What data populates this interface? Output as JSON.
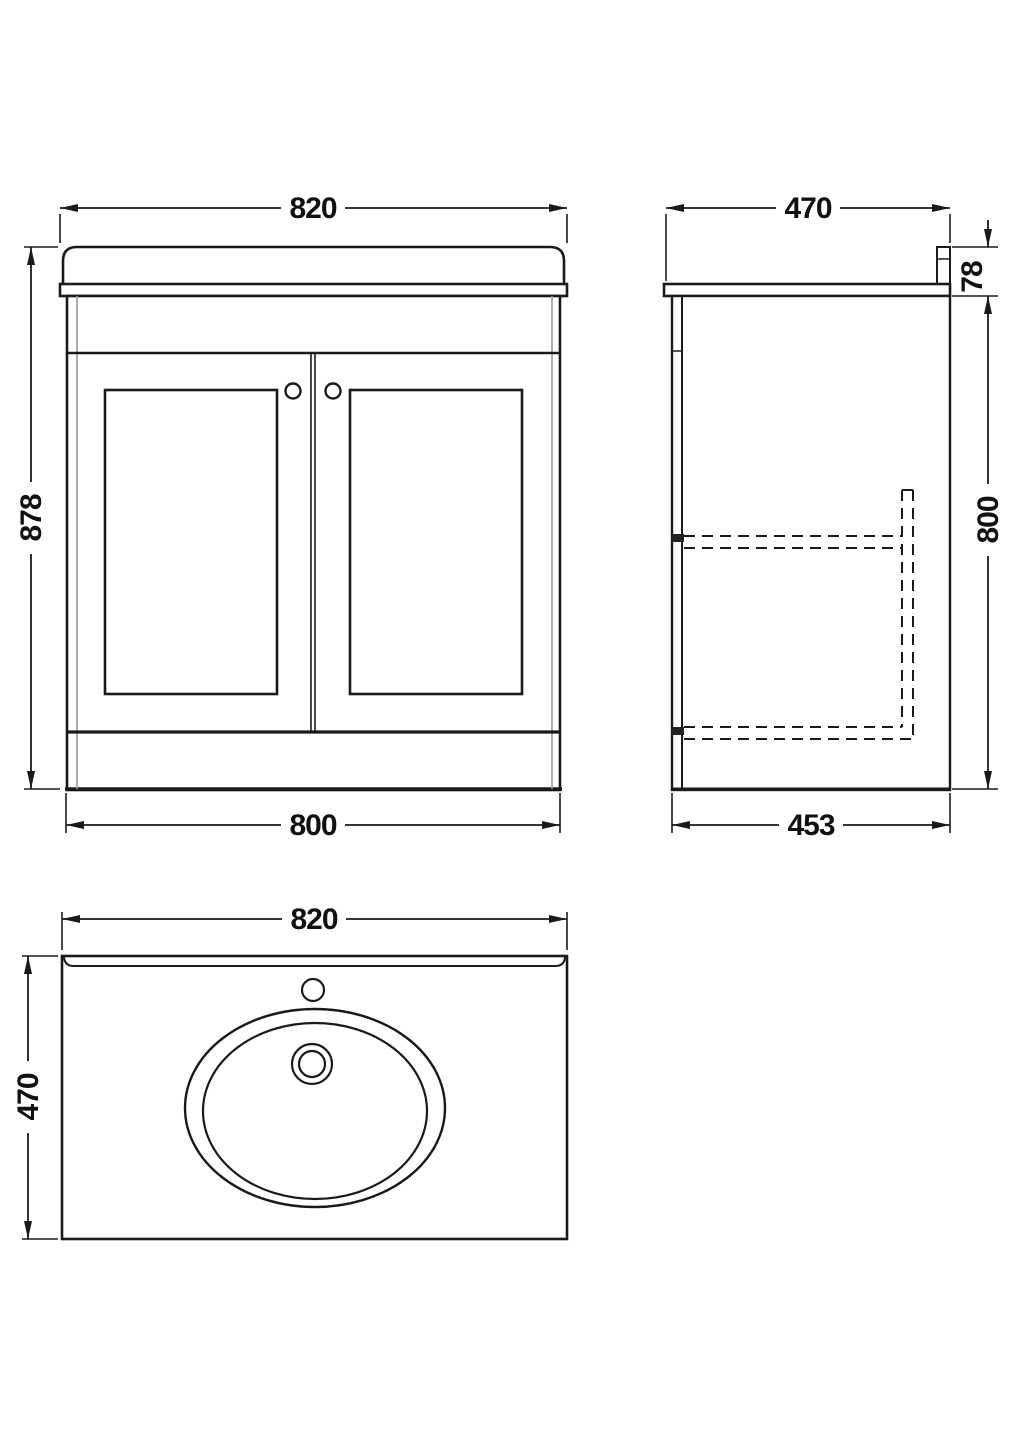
{
  "drawing": {
    "colors": {
      "line": "#1a1a1a",
      "secondary_line": "#999999",
      "background": "#ffffff"
    },
    "front": {
      "top_width": "820",
      "height": "878",
      "bottom_width": "800"
    },
    "side": {
      "depth": "470",
      "worktop_height": "78",
      "cabinet_height": "800",
      "bottom_depth": "453"
    },
    "plan": {
      "width": "820",
      "depth": "470"
    }
  }
}
